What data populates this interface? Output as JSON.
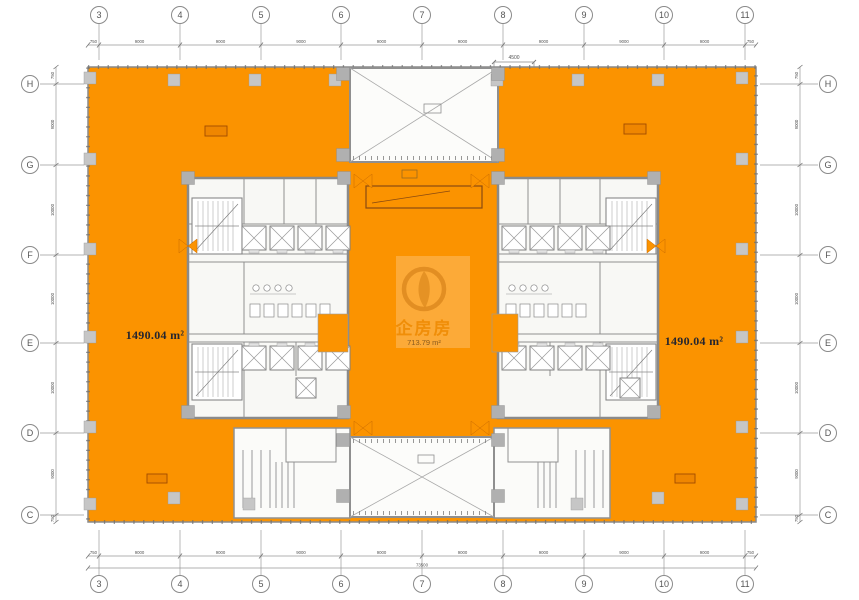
{
  "drawing": {
    "type": "architectural-floor-plan",
    "grid": {
      "cols": [
        "3",
        "4",
        "5",
        "6",
        "7",
        "8",
        "9",
        "10",
        "11"
      ],
      "rows": [
        "H",
        "G",
        "F",
        "E",
        "D",
        "C"
      ]
    },
    "dimensions": {
      "top": [
        "750",
        "9000",
        "9000",
        "9000",
        "9000",
        "9000",
        "9000",
        "9000",
        "9000",
        "750"
      ],
      "bottom": [
        "750",
        "9000",
        "9000",
        "9000",
        "9000",
        "9000",
        "9000",
        "9000",
        "9000",
        "750"
      ],
      "left": [
        "750",
        "9000",
        "10000",
        "10000",
        "10000",
        "9000",
        "750"
      ],
      "right": [
        "750",
        "9000",
        "10000",
        "10000",
        "10000",
        "9000",
        "750"
      ],
      "bottom_total": "73500",
      "top_center": "4500"
    },
    "areas": {
      "left_wing": "1490.04 m²",
      "right_wing": "1490.04 m²",
      "center_lobby": "713.79 m²"
    },
    "watermark": {
      "brand": "企房房"
    },
    "colors": {
      "wing_orange": "#FB9300",
      "core_fill": "#F8F8F5",
      "column_gray": "#C6C6C6",
      "line_gray": "#8A8A8A",
      "watermark_orange": "#DD8A1E",
      "equipment_outline": "#A04C00"
    }
  }
}
